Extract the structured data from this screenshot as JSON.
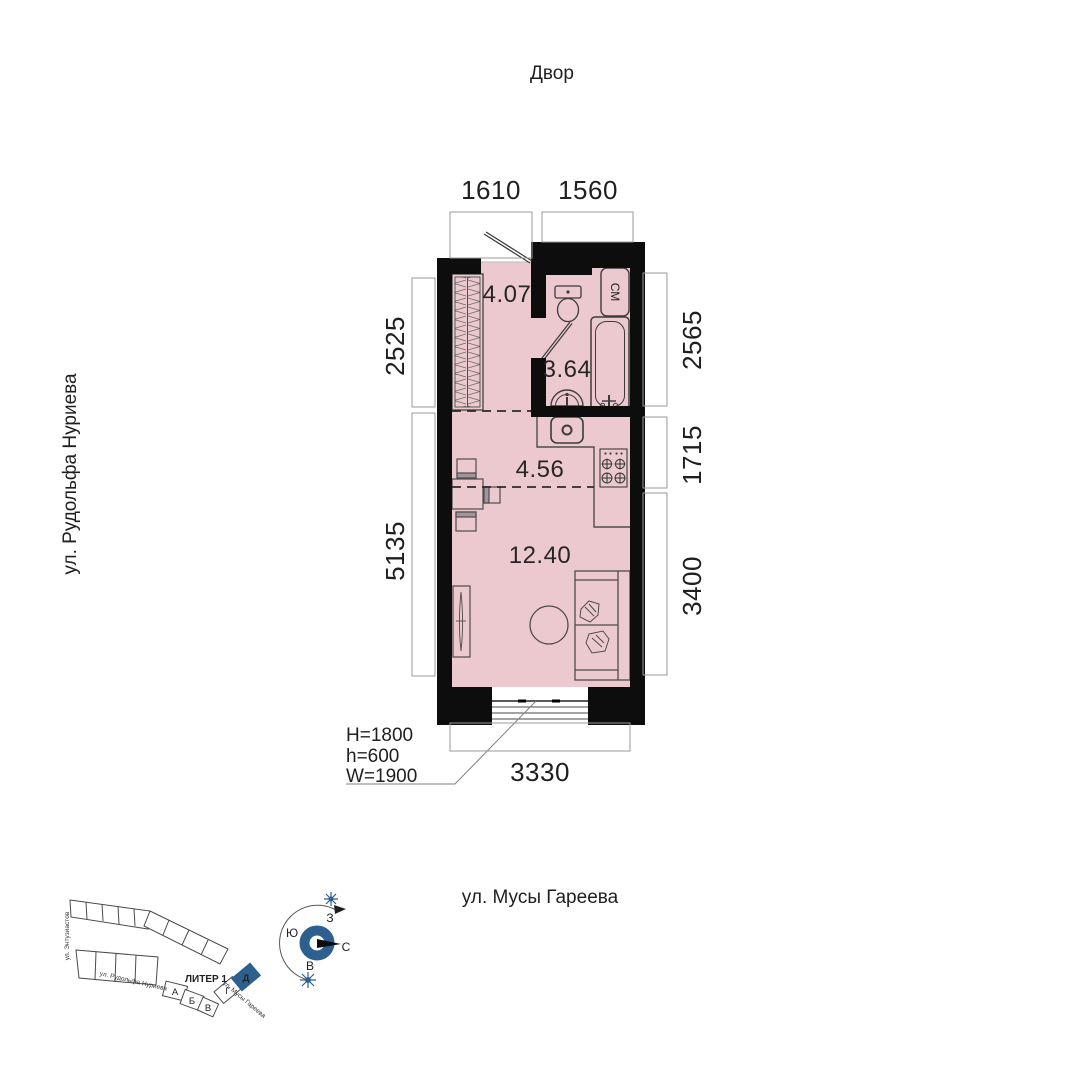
{
  "header": {
    "courtyard_label": "Двор"
  },
  "streets": {
    "left_vertical": "ул. Рудольфа Нуриева",
    "bottom": "ул. Мусы Гареева"
  },
  "plan": {
    "rooms": [
      {
        "id": "hallway",
        "area": "4.07"
      },
      {
        "id": "bathroom",
        "area": "3.64"
      },
      {
        "id": "kitchen",
        "area": "4.56"
      },
      {
        "id": "living",
        "area": "12.40"
      }
    ],
    "appliance_labels": {
      "washing_machine": "СМ"
    }
  },
  "dimensions": {
    "top": [
      "1610",
      "1560"
    ],
    "left": [
      "2525",
      "5135"
    ],
    "right": [
      "2565",
      "1715",
      "3400"
    ],
    "bottom": [
      "3330"
    ]
  },
  "window_spec": {
    "lines": [
      "H=1800",
      "h=600",
      "W=1900"
    ]
  },
  "site_plan": {
    "liter_label": "ЛИТЕР 1",
    "blocks": [
      "А",
      "Б",
      "В",
      "Г",
      "Д"
    ],
    "highlighted_block": "Д",
    "streets": {
      "vertical": "ул. Энтузиастов",
      "diagonal": "ул. Рудольфа Нуриева",
      "bottom": "ул. Мусы Гареева"
    }
  },
  "compass": {
    "west": "З",
    "south": "Ю",
    "north": "С",
    "east": "В"
  },
  "colors": {
    "room_fill": "#ecc9ce",
    "wall": "#0d0d0d",
    "accent_blue": "#2d5f8f",
    "dim_text": "#1f1f1f"
  }
}
